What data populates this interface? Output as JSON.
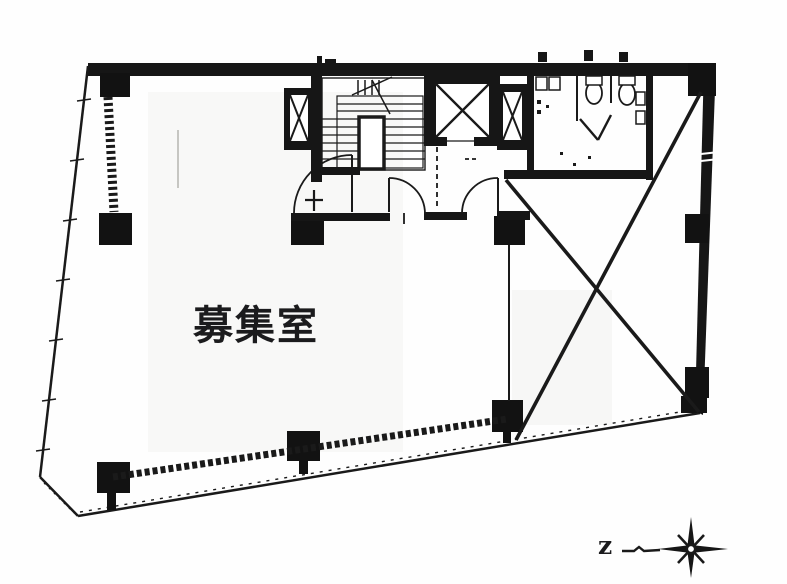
{
  "page": {
    "background": "#ffffff",
    "ink_color": "#1a1a1a"
  },
  "floor_plan": {
    "room_label": "募集室",
    "compass": {
      "letter": "z"
    }
  }
}
